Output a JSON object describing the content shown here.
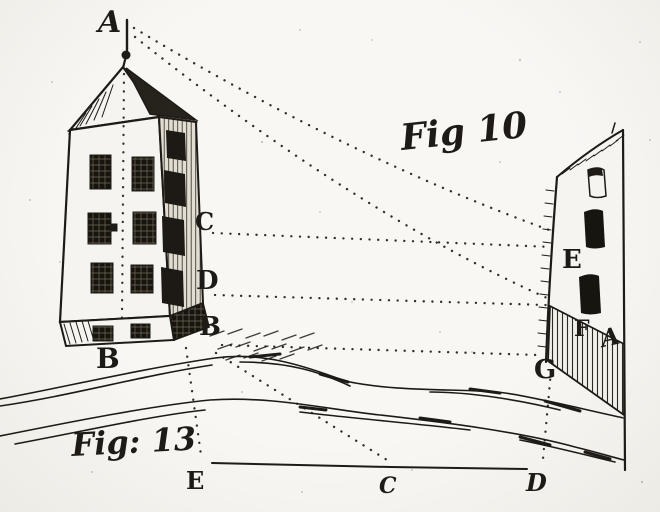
{
  "labels": {
    "apex_a": "A",
    "tower_c": "C",
    "tower_d": "D",
    "tower_b_corner": "B",
    "tower_b_front": "B",
    "fig10": "Fig 10",
    "wall_e": "E",
    "wall_f": "F",
    "wall_a": "A",
    "wall_g": "G",
    "fig13": "Fig: 13",
    "base_e": "E",
    "base_c": "C",
    "base_d": "D"
  },
  "colors": {
    "paper": "#f5f4f0",
    "ink": "#1e1b16"
  }
}
